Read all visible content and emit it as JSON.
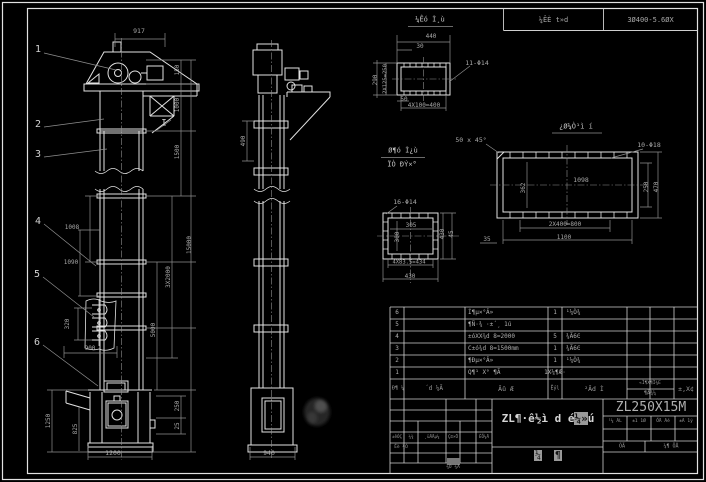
{
  "colors": {
    "background": "#000000",
    "object_line": "#e2e2e2",
    "dim_line": "#8f8f8f",
    "dim_text": "#a8a8a8",
    "table_line": "#cfcfcf",
    "highlight": "#9a9a9a"
  },
  "header": {
    "spec_cell": "¼ÊÈ t»d",
    "power_cell": "3Ø400-5.6ØX"
  },
  "labels": [
    {
      "t": "1",
      "x": 38,
      "y": 50,
      "r": 0,
      "s": 10,
      "c": "callout"
    },
    {
      "t": "2",
      "x": 38,
      "y": 125,
      "r": 0,
      "s": 10,
      "c": "callout"
    },
    {
      "t": "3",
      "x": 38,
      "y": 155,
      "r": 0,
      "s": 10,
      "c": "callout"
    },
    {
      "t": "4",
      "x": 38,
      "y": 222,
      "r": 0,
      "s": 10,
      "c": "callout"
    },
    {
      "t": "5",
      "x": 37,
      "y": 275,
      "r": 0,
      "s": 10,
      "c": "callout"
    },
    {
      "t": "6",
      "x": 37,
      "y": 343,
      "r": 0,
      "s": 10,
      "c": "callout"
    },
    {
      "t": "I",
      "x": 164,
      "y": 124,
      "r": 0,
      "s": 9,
      "c": "callout"
    },
    {
      "t": "¼Êó Ì¸ù",
      "x": 430,
      "y": 20,
      "r": 0,
      "s": 7,
      "c": "title"
    },
    {
      "t": "Ø¶ó Ì¿ù",
      "x": 403,
      "y": 151,
      "r": 0,
      "s": 7,
      "c": "title"
    },
    {
      "t": "ÏÒ ĐÝ×°",
      "x": 402,
      "y": 165,
      "r": 0,
      "s": 7,
      "c": "title"
    },
    {
      "t": "¿Ø¼Ò¹ì í",
      "x": 576,
      "y": 127,
      "r": 0,
      "s": 7,
      "c": "title"
    },
    {
      "t": "917",
      "x": 139,
      "y": 31,
      "r": 0,
      "s": 6.5,
      "c": "dim"
    },
    {
      "t": "150",
      "x": 178,
      "y": 70,
      "r": -90,
      "s": 6,
      "c": "dim"
    },
    {
      "t": "1000",
      "x": 178,
      "y": 105,
      "r": -90,
      "s": 6,
      "c": "dim"
    },
    {
      "t": "1500",
      "x": 178,
      "y": 152,
      "r": -90,
      "s": 6,
      "c": "dim"
    },
    {
      "t": "3X2000",
      "x": 169,
      "y": 277,
      "r": -90,
      "s": 6,
      "c": "dim"
    },
    {
      "t": "5000",
      "x": 154,
      "y": 330,
      "r": -90,
      "s": 6,
      "c": "dim"
    },
    {
      "t": "15000",
      "x": 190,
      "y": 245,
      "r": -90,
      "s": 6,
      "c": "dim"
    },
    {
      "t": "1008",
      "x": 72,
      "y": 228,
      "r": 0,
      "s": 6,
      "c": "dim"
    },
    {
      "t": "1090",
      "x": 71,
      "y": 263,
      "r": 0,
      "s": 6,
      "c": "dim"
    },
    {
      "t": "320",
      "x": 68,
      "y": 324,
      "r": -90,
      "s": 6,
      "c": "dim"
    },
    {
      "t": "900",
      "x": 90,
      "y": 349,
      "r": 0,
      "s": 6,
      "c": "dim"
    },
    {
      "t": "1250",
      "x": 49,
      "y": 421,
      "r": -90,
      "s": 6,
      "c": "dim"
    },
    {
      "t": "825",
      "x": 76,
      "y": 429,
      "r": -90,
      "s": 6,
      "c": "dim"
    },
    {
      "t": "250",
      "x": 178,
      "y": 406,
      "r": -90,
      "s": 6,
      "c": "dim"
    },
    {
      "t": "25",
      "x": 178,
      "y": 426,
      "r": -90,
      "s": 6,
      "c": "dim"
    },
    {
      "t": "1200",
      "x": 113,
      "y": 453,
      "r": 0,
      "s": 6.5,
      "c": "dim"
    },
    {
      "t": "490",
      "x": 244,
      "y": 141,
      "r": -90,
      "s": 6,
      "c": "dim"
    },
    {
      "t": "940",
      "x": 269,
      "y": 453,
      "r": 0,
      "s": 6.5,
      "c": "dim"
    },
    {
      "t": "440",
      "x": 431,
      "y": 37,
      "r": 0,
      "s": 6,
      "c": "dim"
    },
    {
      "t": "30",
      "x": 420,
      "y": 47,
      "r": 0,
      "s": 6,
      "c": "dim"
    },
    {
      "t": "11-Φ14",
      "x": 477,
      "y": 63,
      "r": 0,
      "s": 6.5,
      "c": "dim"
    },
    {
      "t": "290",
      "x": 376,
      "y": 80,
      "r": -90,
      "s": 6,
      "c": "dim"
    },
    {
      "t": "2X125=250",
      "x": 386,
      "y": 79,
      "r": -90,
      "s": 5.5,
      "c": "dim"
    },
    {
      "t": "50",
      "x": 404,
      "y": 100,
      "r": 0,
      "s": 6,
      "c": "dim"
    },
    {
      "t": "4X100=400",
      "x": 424,
      "y": 106,
      "r": 0,
      "s": 6,
      "c": "dim"
    },
    {
      "t": "50 x 45°",
      "x": 471,
      "y": 140,
      "r": 0,
      "s": 6.5,
      "c": "dim"
    },
    {
      "t": "10-Φ18",
      "x": 649,
      "y": 145,
      "r": 0,
      "s": 6.5,
      "c": "dim"
    },
    {
      "t": "1098",
      "x": 581,
      "y": 180,
      "r": 0,
      "s": 6.5,
      "c": "dim"
    },
    {
      "t": "362",
      "x": 524,
      "y": 188,
      "r": -90,
      "s": 6,
      "c": "dim"
    },
    {
      "t": "250",
      "x": 647,
      "y": 187,
      "r": -90,
      "s": 6,
      "c": "dim"
    },
    {
      "t": "470",
      "x": 657,
      "y": 187,
      "r": -90,
      "s": 6,
      "c": "dim"
    },
    {
      "t": "2X400=800",
      "x": 565,
      "y": 225,
      "r": 0,
      "s": 6,
      "c": "dim"
    },
    {
      "t": "1100",
      "x": 564,
      "y": 238,
      "r": 0,
      "s": 6,
      "c": "dim"
    },
    {
      "t": "45",
      "x": 452,
      "y": 234,
      "r": -90,
      "s": 6,
      "c": "dim"
    },
    {
      "t": "35",
      "x": 487,
      "y": 240,
      "r": 0,
      "s": 6,
      "c": "dim"
    },
    {
      "t": "430",
      "x": 443,
      "y": 234,
      "r": -90,
      "s": 6,
      "c": "dim"
    },
    {
      "t": "16-Φ14",
      "x": 405,
      "y": 202,
      "r": 0,
      "s": 6.5,
      "c": "dim"
    },
    {
      "t": "305",
      "x": 411,
      "y": 226,
      "r": 0,
      "s": 6,
      "c": "dim"
    },
    {
      "t": "300",
      "x": 398,
      "y": 237,
      "r": -90,
      "s": 6,
      "c": "dim"
    },
    {
      "t": "4X83.5=434",
      "x": 409,
      "y": 263,
      "r": 0,
      "s": 5.5,
      "c": "dim"
    },
    {
      "t": "430",
      "x": 410,
      "y": 277,
      "r": 0,
      "s": 6,
      "c": "dim"
    },
    {
      "t": "Đ¶ ¼",
      "x": 398,
      "y": 389,
      "r": 0,
      "s": 5,
      "c": "tiny"
    },
    {
      "t": "´d ¼Ã",
      "x": 434,
      "y": 389,
      "r": 0,
      "s": 6,
      "c": "tiny"
    },
    {
      "t": "Ãû Æ",
      "x": 506,
      "y": 389,
      "r": 0,
      "s": 6.5,
      "c": "tiny"
    },
    {
      "t": "Êýl",
      "x": 555,
      "y": 389,
      "r": 0,
      "s": 5,
      "c": "tiny"
    },
    {
      "t": "²Ãd Ì",
      "x": 594,
      "y": 389,
      "r": 0,
      "s": 6.5,
      "c": "tiny"
    },
    {
      "t": "«Ì¶X¶Ì¾E",
      "x": 650,
      "y": 384,
      "r": 0,
      "s": 4.5,
      "c": "tiny"
    },
    {
      "t": "¶Ä¾¼",
      "x": 650,
      "y": 394,
      "r": 0,
      "s": 5,
      "c": "tiny"
    },
    {
      "t": "±,X¢",
      "x": 686,
      "y": 389,
      "r": 0,
      "s": 6.5,
      "c": "tiny"
    },
    {
      "t": "±êÓÇ",
      "x": 397,
      "y": 437,
      "r": 0,
      "s": 4.2,
      "c": "tiny"
    },
    {
      "t": "¼¾",
      "x": 411,
      "y": 437,
      "r": 0,
      "s": 4.2,
      "c": "tiny"
    },
    {
      "t": "¸üÄÄμ¼",
      "x": 432,
      "y": 437,
      "r": 0,
      "s": 4.2,
      "c": "tiny"
    },
    {
      "t": "Ç©×Ö",
      "x": 453,
      "y": 437,
      "r": 0,
      "s": 4.2,
      "c": "tiny"
    },
    {
      "t": "ÈÕ¼Ä",
      "x": 484,
      "y": 437,
      "r": 0,
      "s": 4.2,
      "c": "tiny"
    },
    {
      "t": "Éè ¼Ó",
      "x": 401,
      "y": 448,
      "r": 0,
      "s": 4.5,
      "c": "tiny"
    },
    {
      "t": "¼Ó ¼Ä",
      "x": 453,
      "y": 468,
      "r": 0,
      "s": 4.5,
      "c": "tiny"
    },
    {
      "t": "¹¼ ÃL",
      "x": 615,
      "y": 422,
      "r": 0,
      "s": 4.5,
      "c": "tiny"
    },
    {
      "t": "±1 1Ø",
      "x": 639,
      "y": 422,
      "r": 0,
      "s": 4.5,
      "c": "tiny"
    },
    {
      "t": "ÕÄ Ãé",
      "x": 663,
      "y": 422,
      "r": 0,
      "s": 4.5,
      "c": "tiny"
    },
    {
      "t": "±Ã 1ý",
      "x": 686,
      "y": 422,
      "r": 0,
      "s": 4.5,
      "c": "tiny"
    },
    {
      "t": "ÕÄ",
      "x": 622,
      "y": 447,
      "r": 0,
      "s": 5,
      "c": "tiny"
    },
    {
      "t": "¼¶ ÖÅ",
      "x": 671,
      "y": 447,
      "r": 0,
      "s": 5,
      "c": "tiny"
    }
  ],
  "bom": {
    "rows": [
      {
        "no": "6",
        "code": "",
        "name": "Í¶µ×°Â»",
        "qty": "1",
        "material": "¹¼Ò¾",
        "w1": "",
        "w2": "",
        "remark": ""
      },
      {
        "no": "5",
        "code": "",
        "name": "¶Ñ·¾ ·±´¸ 1ú",
        "qty": "",
        "material": "",
        "w1": "",
        "w2": "",
        "remark": ""
      },
      {
        "no": "4",
        "code": "",
        "name": "±óXX¾d 8=2000",
        "qty": "5",
        "material": "¾Ã6Ͼ",
        "w1": "",
        "w2": "",
        "remark": ""
      },
      {
        "no": "3",
        "code": "",
        "name": "C±ó¾d 8=1500mm",
        "qty": "1",
        "material": "¾Ã6Ͼ",
        "w1": "",
        "w2": "",
        "remark": ""
      },
      {
        "no": "2",
        "code": "",
        "name": "¶Ðµ×°Â»",
        "qty": "1",
        "material": "¹¼Ò¾",
        "w1": "",
        "w2": "",
        "remark": ""
      },
      {
        "no": "1",
        "code": "",
        "name": "Q¶¹ X° ¶Ã",
        "qty": "1X¼¶Æ·",
        "material": "",
        "w1": "",
        "w2": "",
        "remark": ""
      }
    ]
  },
  "title_block": {
    "product_title_main": "ZL¶·ê½ì d é",
    "product_title_hl": "¼»",
    "product_title_tail": "ú",
    "model": "ZL250X15M",
    "sheet_char1": "¼",
    "sheet_char2": "¶"
  }
}
